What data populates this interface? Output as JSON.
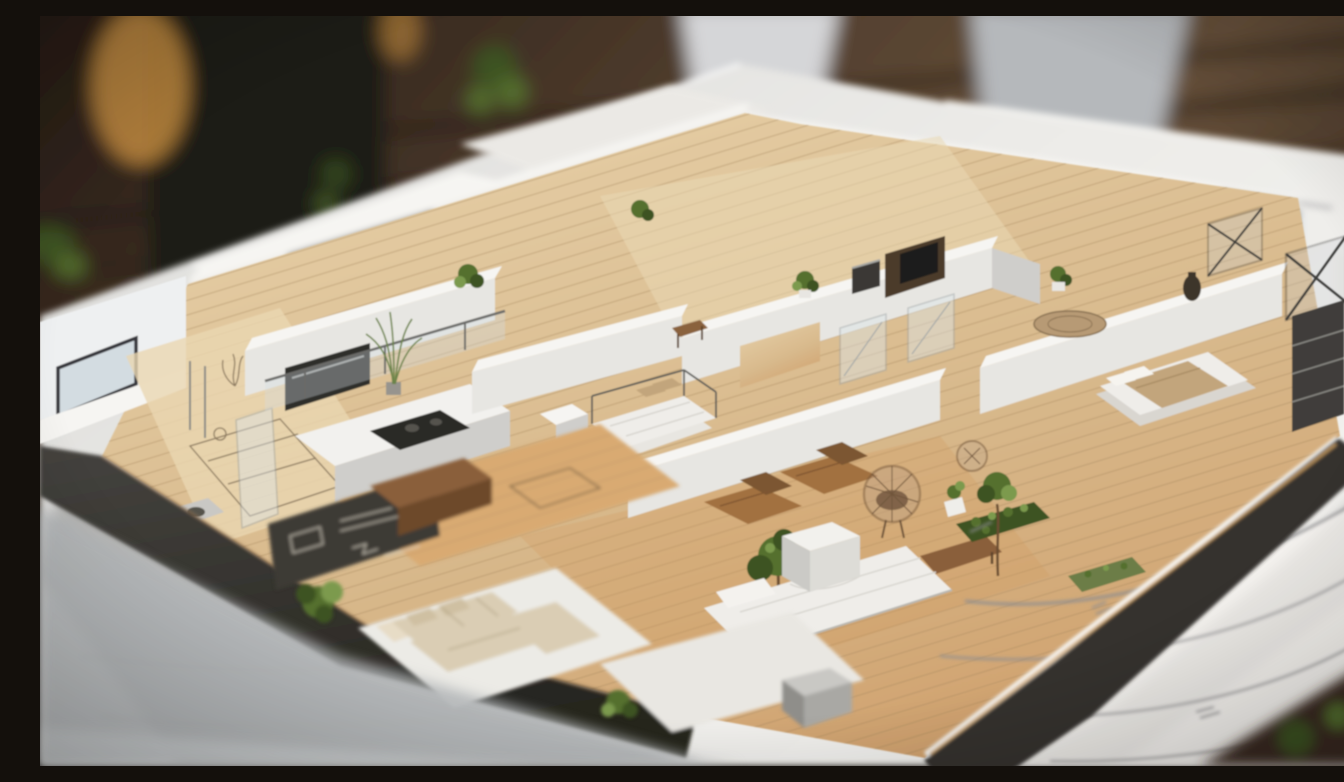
{
  "scene": {
    "description": "Photorealistic miniature 3D architectural model of a modern apartment floor plan, with white walls, light oak floors, miniature furniture and tiny green plants, standing on white blueprint sketch paper on a dark walnut desk; shallow depth of field blurs the desk background and the paper foreground.",
    "environment": {
      "surface": "dark walnut wooden desk, blurred",
      "background_objects": [
        "dark cabinet",
        "warm amber lamp glow",
        "standing white sheet",
        "gray laptop-like object",
        "blurred green houseplants"
      ],
      "paper": "white architectural blueprint sheet with pencil sketch lines and small handwritten marks"
    },
    "model": {
      "structure": [
        "white perimeter walls with dark-framed windows",
        "glass curtain wall with dark mullions",
        "charcoal base walls with warm edge light",
        "light oak plank flooring",
        "interior partition walls"
      ],
      "furniture": [
        "kitchen counter with dark cooktop",
        "kitchen island with glass railing",
        "canopy platform bed with white duvet and tan pillows",
        "white chaise sofa bed",
        "white cube side table",
        "two brown wooden lounge chaises",
        "round wicker basket chair",
        "cream L-shaped sectional sofa on white platform",
        "double bed with tan blanket",
        "round tan rug",
        "dark media console and espresso machine",
        "dark shelf tower and lattice screens",
        "gray basin and glass partition",
        "chalk sketch panel with white drawing lines",
        "gray cube sculpture on white plinth",
        "wooden bench"
      ],
      "plants": [
        "tall grass in pot",
        "small potted shrubs",
        "two miniature trees",
        "green hedge patch",
        "moss patch",
        "corner bushes"
      ]
    },
    "palette": {
      "table_wood_dark": "#241a14",
      "table_wood": "#4e3b2b",
      "table_wood_light": "#6b523c",
      "amber_glow": "#d79a45",
      "paper": "#f2f1ed",
      "paper_shadow": "#b4b7ba",
      "paper_bright": "#f7f5f1",
      "pencil": "#8d8d90",
      "model_white": "#f6f5f2",
      "wall_face": "#e7e6e2",
      "wall_shade": "#cfcecb",
      "charcoal": "#34332f",
      "charcoal_light": "#45433f",
      "floor_light": "#e6cfa7",
      "floor": "#d8b98c",
      "floor_warm": "#cf9f6b",
      "plank": "#a98a60",
      "glass": "#d3dce1",
      "frame": "#35353a",
      "sofa_cream": "#dacdb4",
      "sofa_white": "#efede9",
      "wood_furniture": "#8a5f3a",
      "chaise_brown": "#a2713f",
      "bed_tan": "#c2a57c",
      "rug": "#b79a74",
      "plant_green": "#55702f",
      "plant_dark": "#3c5222",
      "plant_light": "#7c9a4e",
      "sketch_panel": "#3e3a34",
      "chalk": "#d8d2c4",
      "warm_edge": "#d8a868"
    }
  }
}
